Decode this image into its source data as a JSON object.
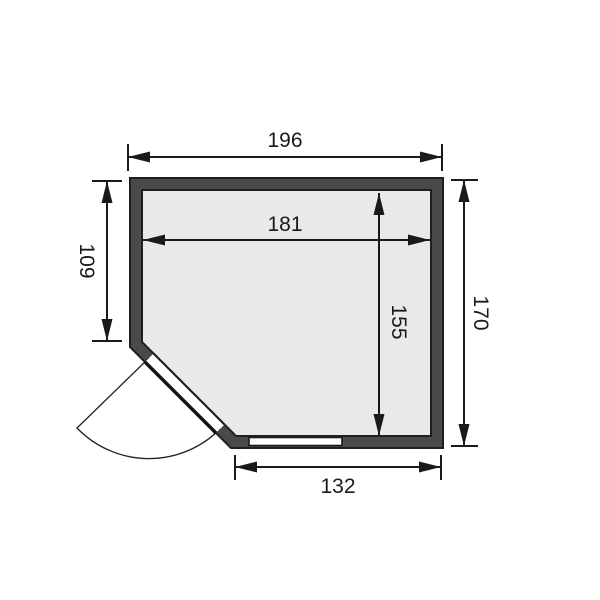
{
  "diagram": {
    "kind": "corner-entry floor plan with dimension lines",
    "units_shown": false
  },
  "colors": {
    "background": "#ffffff",
    "wall_fill": "#4a4a4a",
    "interior_fill": "#e9e9e9",
    "line": "#1a1a1a",
    "door_fill": "#ffffff",
    "window_fill": "#ffffff"
  },
  "dimensions": {
    "outer_width": {
      "value": "196",
      "position": "top, horizontal"
    },
    "inner_width": {
      "value": "181",
      "position": "inside room, horizontal"
    },
    "left_height": {
      "value": "109",
      "position": "left, vertical, rotated"
    },
    "outer_height": {
      "value": "170",
      "position": "right, vertical, rotated"
    },
    "inner_height": {
      "value": "155",
      "position": "inside room, vertical, rotated"
    },
    "bottom_width": {
      "value": "132",
      "position": "bottom, horizontal"
    }
  }
}
